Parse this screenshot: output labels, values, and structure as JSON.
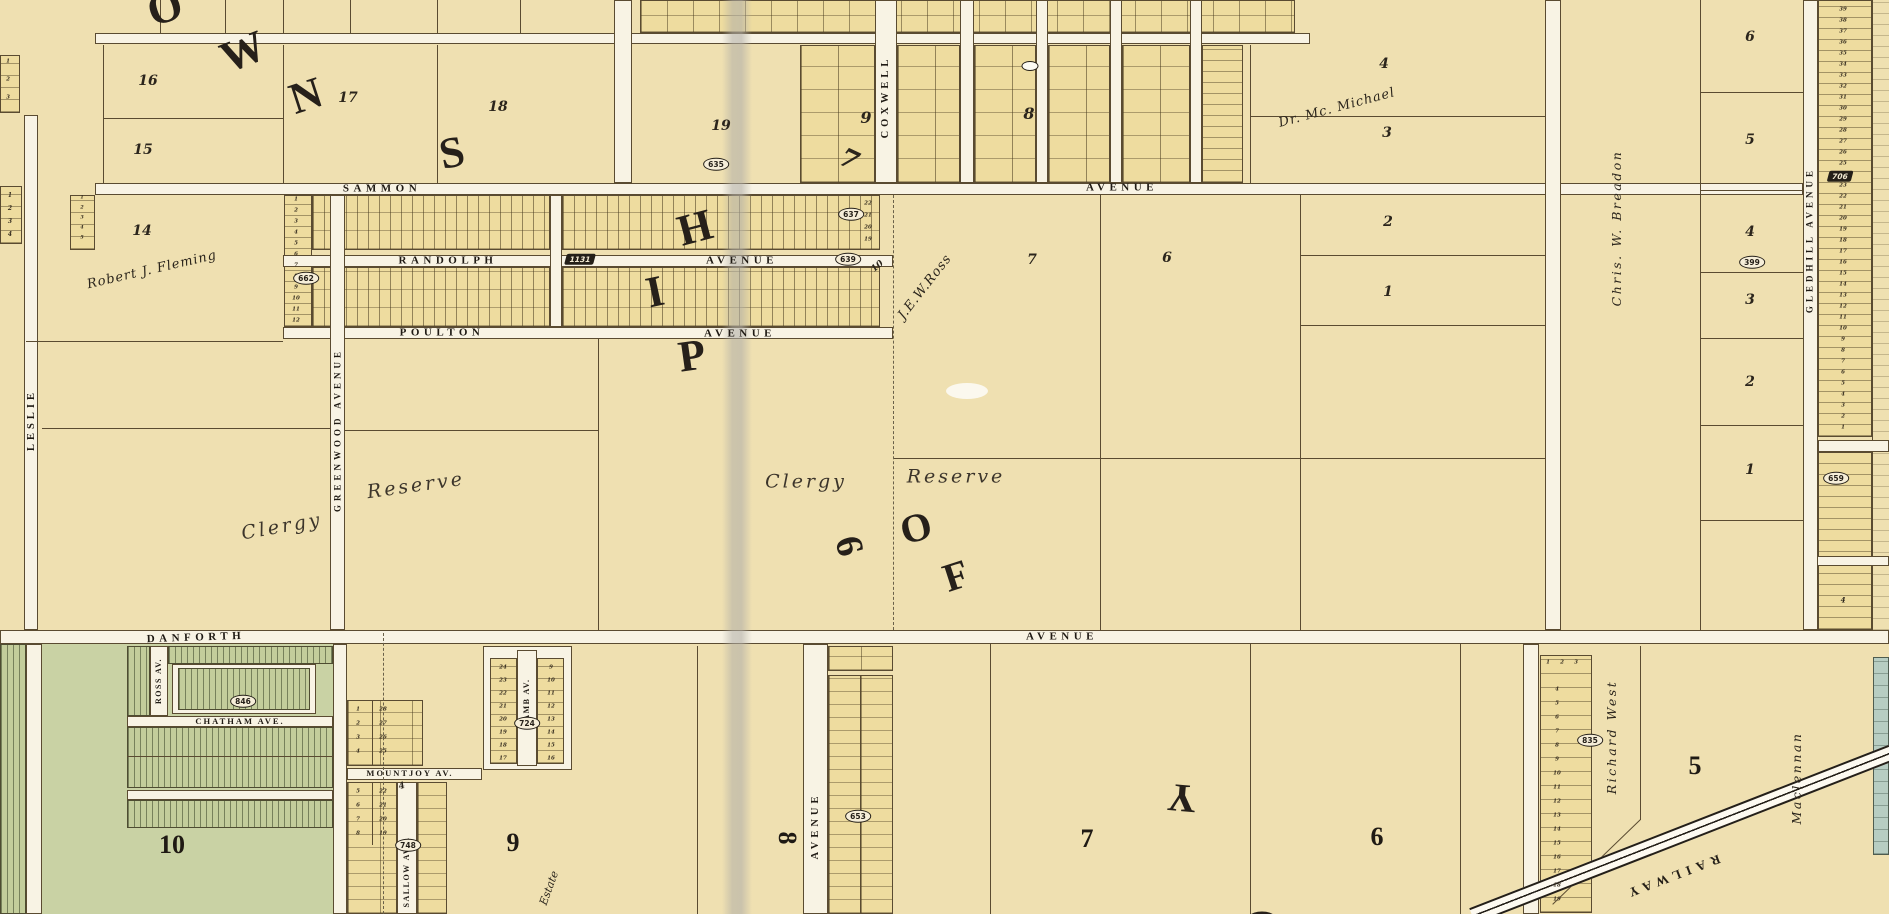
{
  "map_type": "historical cadastral atlas plate, Township of York (Toronto), cream parchment with subdivision lot grids",
  "colors": {
    "parchment": "#efe0b1",
    "road": "#f8f3e4",
    "ink": "#241f18",
    "green_subdivision": "#c3cd9b",
    "teal_strip": "#b7cdc2",
    "fold_crease": "#b0aea6"
  },
  "big_overlay_words": {
    "township_letters": [
      "O",
      "W",
      "N",
      "S",
      "H",
      "I",
      "P"
    ],
    "of_letters": [
      "O",
      "F"
    ],
    "york_letters": [
      "Y",
      "O"
    ]
  },
  "items": [
    {
      "n": "sammon-street-label",
      "t": "SAMMON",
      "x": 382,
      "y": 189,
      "c": "street"
    },
    {
      "n": "sammon-avenue-label",
      "t": "AVENUE",
      "x": 1122,
      "y": 188,
      "c": "street"
    },
    {
      "n": "randolph-street-label",
      "t": "RANDOLPH",
      "x": 448,
      "y": 261,
      "c": "street"
    },
    {
      "n": "randolph-avenue-label",
      "t": "AVENUE",
      "x": 742,
      "y": 261,
      "c": "street"
    },
    {
      "n": "poulton-street-label",
      "t": "POULTON",
      "x": 442,
      "y": 333,
      "c": "street"
    },
    {
      "n": "poulton-avenue-label",
      "t": "AVENUE",
      "x": 740,
      "y": 334,
      "c": "street"
    },
    {
      "n": "danforth-street-label",
      "t": "DANFORTH",
      "x": 196,
      "y": 638,
      "r": -2,
      "c": "street"
    },
    {
      "n": "danforth-avenue-label",
      "t": "AVENUE",
      "x": 1062,
      "y": 637,
      "c": "street"
    },
    {
      "n": "coxwell-street-label",
      "t": "COXWELL",
      "x": 886,
      "y": 97,
      "r": -90,
      "c": "vstreet"
    },
    {
      "n": "coxwell-south-avenue-label",
      "t": "AVENUE",
      "x": 816,
      "y": 826,
      "r": -90,
      "c": "vstreet"
    },
    {
      "n": "greenwood-avenue-label",
      "t": "GREENWOOD AVENUE",
      "x": 338,
      "y": 430,
      "r": -90,
      "c": "vstreet",
      "fs": 9
    },
    {
      "n": "leslie-street-label",
      "t": "LESLIE",
      "x": 32,
      "y": 420,
      "r": -90,
      "c": "vstreet"
    },
    {
      "n": "gledhill-avenue-label",
      "t": "GLEDHILL AVENUE",
      "x": 1810,
      "y": 240,
      "r": -90,
      "c": "vstreet",
      "fs": 9
    },
    {
      "n": "ross-av-label",
      "t": "ROSS AV.",
      "x": 159,
      "y": 681,
      "r": -90,
      "c": "vstreet-sm"
    },
    {
      "n": "chatham-ave-label",
      "t": "CHATHAM AVE.",
      "x": 240,
      "y": 721,
      "c": "street-sm"
    },
    {
      "n": "mountjoy-av-label",
      "t": "MOUNTJOY AV.",
      "x": 410,
      "y": 773,
      "c": "street-sm"
    },
    {
      "n": "lamb-av-label",
      "t": "LAMB AV.",
      "x": 527,
      "y": 703,
      "r": -90,
      "c": "vstreet-sm"
    },
    {
      "n": "sallow-ave-label",
      "t": "SALLOW AVE.",
      "x": 407,
      "y": 872,
      "r": -90,
      "c": "vstreet-sm"
    },
    {
      "n": "railway-label",
      "t": "RAILWAY",
      "x": 1672,
      "y": 877,
      "r": 159,
      "c": "railway-label"
    },
    {
      "n": "owner-robert-j-fleming",
      "t": "Robert J. Fleming",
      "x": 152,
      "y": 270,
      "r": -13,
      "c": "owner"
    },
    {
      "n": "lot-14-label",
      "t": "14",
      "x": 142,
      "y": 231,
      "c": "lotnum"
    },
    {
      "n": "owner-dr-mcmichael",
      "t": "Dr. Mc. Michael",
      "x": 1337,
      "y": 108,
      "r": -15,
      "c": "owner"
    },
    {
      "n": "owner-jew-ross",
      "t": "J.E.W.Ross",
      "x": 925,
      "y": 287,
      "r": -52,
      "c": "owner"
    },
    {
      "n": "owner-chris-w-breadon",
      "t": "Chris. W. Breadon",
      "x": 1617,
      "y": 228,
      "r": -90,
      "c": "vowner"
    },
    {
      "n": "owner-richard-west",
      "t": "Richard West",
      "x": 1612,
      "y": 737,
      "r": -90,
      "c": "vowner"
    },
    {
      "n": "owner-maclennan",
      "t": "Maclennan",
      "x": 1797,
      "y": 778,
      "r": -90,
      "c": "vowner"
    },
    {
      "n": "owner-estate",
      "t": "Estate",
      "x": 549,
      "y": 888,
      "r": -70,
      "c": "owner-sm"
    },
    {
      "n": "clergy-reserve-west-1",
      "t": "Clergy",
      "x": 282,
      "y": 527,
      "r": -10,
      "c": "clergy"
    },
    {
      "n": "clergy-reserve-west-2",
      "t": "Reserve",
      "x": 416,
      "y": 486,
      "r": -8,
      "c": "clergy"
    },
    {
      "n": "clergy-reserve-mid-1",
      "t": "Clergy",
      "x": 806,
      "y": 482,
      "c": "clergy"
    },
    {
      "n": "clergy-reserve-mid-2",
      "t": "Reserve",
      "x": 956,
      "y": 477,
      "c": "clergy"
    },
    {
      "n": "lot-16-label",
      "t": "16",
      "x": 148,
      "y": 81,
      "c": "lotnum"
    },
    {
      "n": "lot-15-label",
      "t": "15",
      "x": 143,
      "y": 150,
      "c": "lotnum"
    },
    {
      "n": "lot-17-label",
      "t": "17",
      "x": 348,
      "y": 98,
      "c": "lotnum"
    },
    {
      "n": "lot-18-label",
      "t": "18",
      "x": 498,
      "y": 107,
      "c": "lotnum"
    },
    {
      "n": "lot-19-label",
      "t": "19",
      "x": 721,
      "y": 126,
      "c": "lotnum"
    },
    {
      "n": "block-9-label",
      "t": "9",
      "x": 866,
      "y": 118,
      "c": "lotnum-b"
    },
    {
      "n": "block-7-tilted-label",
      "t": "7",
      "x": 849,
      "y": 160,
      "r": 25,
      "c": "big7"
    },
    {
      "n": "block-8-label",
      "t": "8",
      "x": 1029,
      "y": 114,
      "c": "lotnum-b"
    },
    {
      "n": "lot-4-label",
      "t": "4",
      "x": 1384,
      "y": 64,
      "c": "lotnum"
    },
    {
      "n": "lot-3-label",
      "t": "3",
      "x": 1387,
      "y": 133,
      "c": "lotnum"
    },
    {
      "n": "lot-2-label",
      "t": "2",
      "x": 1388,
      "y": 222,
      "c": "lotnum"
    },
    {
      "n": "lot-1-label",
      "t": "1",
      "x": 1388,
      "y": 292,
      "c": "lotnum"
    },
    {
      "n": "lot-7-label",
      "t": "7",
      "x": 1032,
      "y": 260,
      "c": "lotnum"
    },
    {
      "n": "lot-6-label",
      "t": "6",
      "x": 1167,
      "y": 258,
      "c": "lotnum"
    },
    {
      "n": "east-lot-6-label",
      "t": "6",
      "x": 1750,
      "y": 37,
      "c": "lotnum"
    },
    {
      "n": "east-lot-5-label",
      "t": "5",
      "x": 1750,
      "y": 140,
      "c": "lotnum"
    },
    {
      "n": "east-lot-4-label",
      "t": "4",
      "x": 1750,
      "y": 232,
      "c": "lotnum"
    },
    {
      "n": "east-lot-3-label",
      "t": "3",
      "x": 1750,
      "y": 300,
      "c": "lotnum"
    },
    {
      "n": "east-lot-2-label",
      "t": "2",
      "x": 1750,
      "y": 382,
      "c": "lotnum"
    },
    {
      "n": "east-lot-1-label",
      "t": "1",
      "x": 1750,
      "y": 470,
      "c": "lotnum"
    },
    {
      "n": "ross-frontage-number",
      "t": "10",
      "x": 878,
      "y": 267,
      "r": -40,
      "c": "lotnum-sm"
    },
    {
      "n": "mountjoy-small-4",
      "t": "4",
      "x": 402,
      "y": 787,
      "r": -15,
      "c": "lotnum-sm"
    },
    {
      "n": "gledhill-small-4",
      "t": "4",
      "x": 1843,
      "y": 600,
      "c": "tiny-num"
    },
    {
      "n": "south-lot-10-label",
      "t": "10",
      "x": 172,
      "y": 845,
      "c": "bignum"
    },
    {
      "n": "south-lot-9-label",
      "t": "9",
      "x": 513,
      "y": 843,
      "c": "bignum"
    },
    {
      "n": "south-lot-8-label",
      "t": "8",
      "x": 787,
      "y": 838,
      "r": 90,
      "c": "bignum"
    },
    {
      "n": "south-lot-7-label",
      "t": "7",
      "x": 1087,
      "y": 839,
      "c": "bignum"
    },
    {
      "n": "south-lot-6-label",
      "t": "6",
      "x": 1377,
      "y": 837,
      "c": "bignum"
    },
    {
      "n": "south-lot-5-label",
      "t": "5",
      "x": 1695,
      "y": 766,
      "c": "bignum"
    },
    {
      "n": "township-letter-o",
      "t": "O",
      "x": 165,
      "y": 8,
      "r": -18,
      "c": "biglet"
    },
    {
      "n": "township-letter-w",
      "t": "W",
      "x": 243,
      "y": 52,
      "r": -22,
      "c": "biglet"
    },
    {
      "n": "township-letter-n",
      "t": "N",
      "x": 306,
      "y": 96,
      "r": -18,
      "c": "biglet"
    },
    {
      "n": "township-letter-s",
      "t": "S",
      "x": 452,
      "y": 153,
      "r": -12,
      "c": "biglet"
    },
    {
      "n": "township-letter-h",
      "t": "H",
      "x": 695,
      "y": 228,
      "r": -15,
      "c": "biglet"
    },
    {
      "n": "township-letter-i",
      "t": "I",
      "x": 655,
      "y": 292,
      "r": -12,
      "c": "biglet"
    },
    {
      "n": "township-letter-p",
      "t": "P",
      "x": 692,
      "y": 356,
      "r": -8,
      "c": "biglet"
    },
    {
      "n": "of-letter-o",
      "t": "O",
      "x": 916,
      "y": 528,
      "r": -15,
      "c": "biglet",
      "fs": 40
    },
    {
      "n": "of-letter-f",
      "t": "F",
      "x": 956,
      "y": 576,
      "r": -18,
      "c": "biglet",
      "fs": 40
    },
    {
      "n": "york-letter-y",
      "t": "Y",
      "x": 1182,
      "y": 798,
      "r": 185,
      "c": "biglet",
      "fs": 40
    },
    {
      "n": "york-letter-o",
      "t": "O",
      "x": 1262,
      "y": 930,
      "c": "biglet",
      "fs": 52
    },
    {
      "n": "concession-6-numeral",
      "t": "6",
      "x": 849,
      "y": 546,
      "r": 75,
      "c": "biglet",
      "fs": 38
    },
    {
      "n": "plan-badge-635",
      "t": "635",
      "x": 716,
      "y": 164,
      "c": "badge"
    },
    {
      "n": "plan-badge-637",
      "t": "637",
      "x": 851,
      "y": 214,
      "c": "badge"
    },
    {
      "n": "plan-badge-639",
      "t": "639",
      "x": 848,
      "y": 259,
      "c": "badge"
    },
    {
      "n": "plan-badge-1131",
      "t": "1131",
      "x": 580,
      "y": 259,
      "c": "badge-skew"
    },
    {
      "n": "plan-badge-662",
      "t": "662",
      "x": 306,
      "y": 278,
      "c": "badge"
    },
    {
      "n": "plan-badge-846",
      "t": "846",
      "x": 243,
      "y": 701,
      "c": "badge"
    },
    {
      "n": "plan-badge-724",
      "t": "724",
      "x": 527,
      "y": 723,
      "c": "badge"
    },
    {
      "n": "plan-badge-748",
      "t": "748",
      "x": 408,
      "y": 845,
      "c": "badge"
    },
    {
      "n": "plan-badge-653",
      "t": "653",
      "x": 858,
      "y": 816,
      "c": "badge"
    },
    {
      "n": "plan-badge-835",
      "t": "835",
      "x": 1590,
      "y": 740,
      "c": "badge"
    },
    {
      "n": "plan-badge-399",
      "t": "399",
      "x": 1752,
      "y": 262,
      "c": "badge"
    },
    {
      "n": "plan-badge-706",
      "t": "706",
      "x": 1840,
      "y": 176,
      "c": "badge-skew"
    },
    {
      "n": "plan-badge-659",
      "t": "659",
      "x": 1836,
      "y": 478,
      "c": "badge"
    },
    {
      "n": "empty-oval-badge",
      "t": "",
      "x": 1030,
      "y": 66,
      "c": "badge-white"
    }
  ],
  "columns": [
    {
      "n": "far-left-upper-col",
      "x": 8,
      "y": 62,
      "step": 18,
      "fs": 5.5,
      "values": [
        1,
        2,
        3
      ]
    },
    {
      "n": "far-left-col",
      "x": 10,
      "y": 196,
      "step": 13,
      "fs": 6,
      "values": [
        1,
        2,
        3,
        4
      ]
    },
    {
      "n": "leslie-east-col",
      "x": 82,
      "y": 198,
      "step": 10,
      "fs": 5,
      "values": [
        1,
        2,
        3,
        4,
        5
      ]
    },
    {
      "n": "greenwood-west-col",
      "x": 296,
      "y": 200,
      "step": 11,
      "fs": 5.5,
      "values": [
        1,
        2,
        3,
        4,
        5,
        6,
        7,
        8,
        9,
        10,
        11,
        12
      ]
    },
    {
      "n": "sammon-east-col",
      "x": 868,
      "y": 204,
      "step": 12,
      "fs": 5.5,
      "values": [
        22,
        21,
        20,
        19
      ]
    },
    {
      "n": "lamb-west-col",
      "x": 503,
      "y": 668,
      "step": 13,
      "fs": 5.5,
      "values": [
        24,
        23,
        22,
        21,
        20,
        19,
        18,
        17
      ]
    },
    {
      "n": "lamb-east-col",
      "x": 551,
      "y": 668,
      "step": 13,
      "fs": 5.5,
      "values": [
        9,
        10,
        11,
        12,
        13,
        14,
        15,
        16
      ]
    },
    {
      "n": "mountjoy-nw-col",
      "x": 358,
      "y": 710,
      "step": 14,
      "fs": 5.5,
      "values": [
        1,
        2,
        3,
        4
      ]
    },
    {
      "n": "mountjoy-ne-col",
      "x": 383,
      "y": 710,
      "step": 14,
      "fs": 5.5,
      "values": [
        28,
        27,
        26,
        25
      ]
    },
    {
      "n": "mountjoy-sw-col",
      "x": 358,
      "y": 792,
      "step": 14,
      "fs": 5.5,
      "values": [
        5,
        6,
        7,
        8
      ]
    },
    {
      "n": "mountjoy-se-col",
      "x": 383,
      "y": 792,
      "step": 14,
      "fs": 5.5,
      "values": [
        22,
        21,
        20,
        19
      ]
    },
    {
      "n": "richard-west-top-row",
      "x": 1548,
      "y": 663,
      "step": 14,
      "fs": 5.5,
      "dir": "h",
      "values": [
        1,
        2,
        3
      ]
    },
    {
      "n": "richard-west-col",
      "x": 1557,
      "y": 690,
      "step": 14,
      "fs": 5.5,
      "values": [
        4,
        5,
        6,
        7,
        8,
        9,
        10,
        11,
        12,
        13,
        14,
        15,
        16,
        17,
        18,
        19
      ]
    },
    {
      "n": "gledhill-east-col",
      "x": 1843,
      "y": 10,
      "step": 11,
      "fs": 5.5,
      "values": [
        39,
        38,
        37,
        36,
        35,
        34,
        33,
        32,
        31,
        30,
        29,
        28,
        27,
        26,
        25,
        24,
        23,
        22,
        21,
        20,
        19,
        18,
        17,
        16,
        15,
        14,
        13,
        12,
        11,
        10,
        9,
        8,
        7,
        6,
        5,
        4,
        3,
        2,
        1
      ]
    }
  ]
}
